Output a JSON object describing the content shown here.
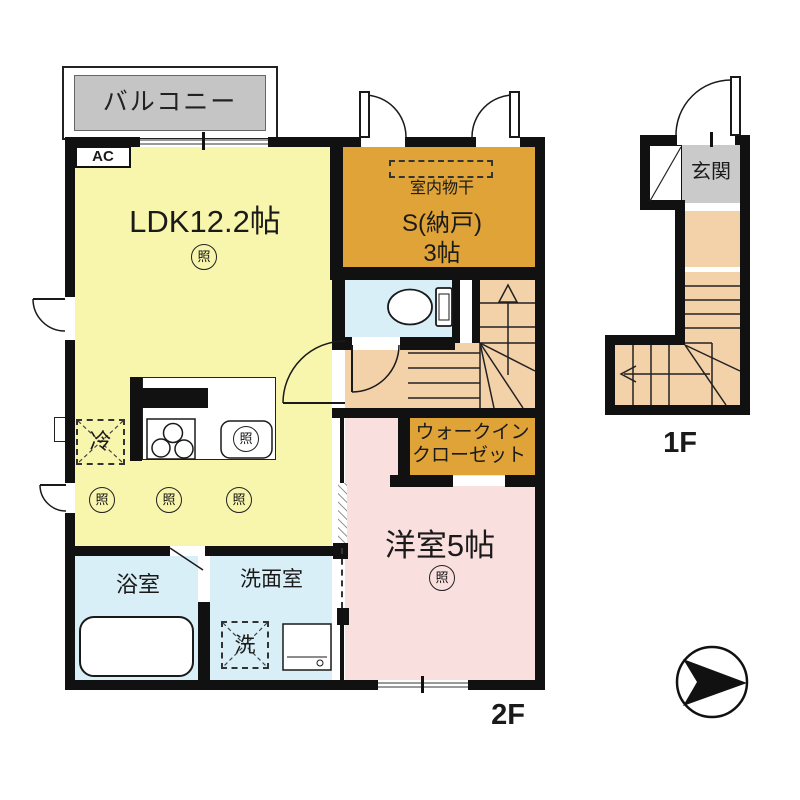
{
  "floorplan": {
    "floor2": {
      "label": "2F",
      "balcony": "バルコニー",
      "ac": "AC",
      "ldk": "LDK12.2帖",
      "light": "照",
      "indoor_drying": "室内物干",
      "storage_name": "S(納戸)",
      "storage_size": "3帖",
      "wic_line1": "ウォークイン",
      "wic_line2": "クローゼット",
      "bedroom": "洋室5帖",
      "bath": "浴室",
      "washroom": "洗面室",
      "washer": "洗",
      "fridge": "冷"
    },
    "floor1": {
      "label": "1F",
      "entrance": "玄関"
    },
    "colors": {
      "wall": "#111111",
      "ldk": "#F8F5AC",
      "storage": "#DFA338",
      "water": "#D9EFF8",
      "bedroom": "#FADFDF",
      "hall": "#F3D2A9",
      "balcony": "#C5C5C5",
      "entrance": "#CACACA"
    }
  }
}
